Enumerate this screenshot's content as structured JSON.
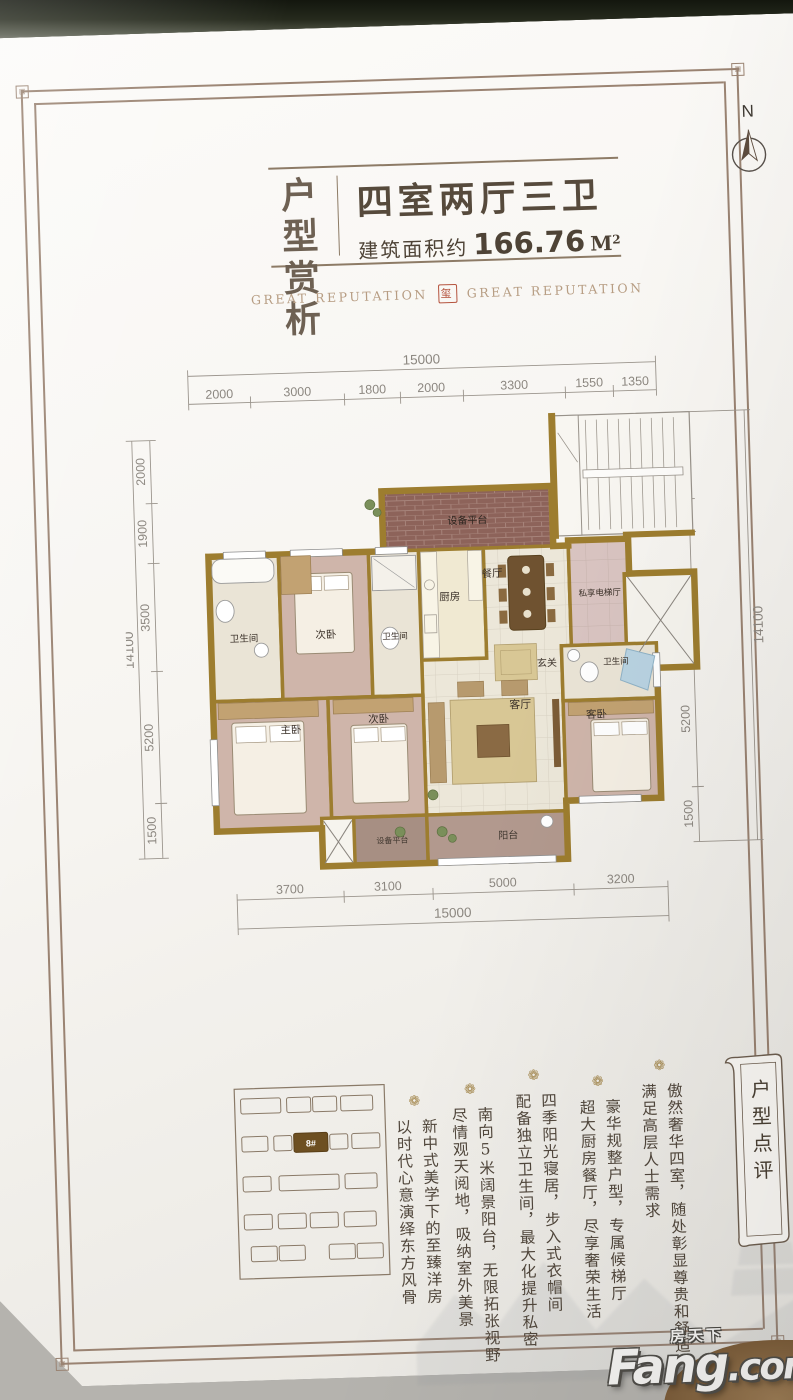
{
  "header": {
    "title_line1": "户型",
    "title_line2": "赏析",
    "type_title": "四室两厅三卫",
    "area_prefix": "建筑面积约",
    "area_value": "166.76",
    "area_unit": "M",
    "area_sup": "2",
    "reputation_left": "GREAT REPUTATION",
    "reputation_right": "GREAT REPUTATION",
    "seal_glyph": "玺"
  },
  "compass": {
    "label": "N"
  },
  "plan": {
    "dims": {
      "top_total": "15000",
      "top_segments": [
        "2000",
        "3000",
        "1800",
        "2000",
        "3300",
        "1550",
        "1350"
      ],
      "bottom_segments": [
        "3700",
        "3100",
        "5000",
        "3200"
      ],
      "bottom_total": "15000",
      "left_segments": [
        "2000",
        "1900",
        "3500",
        "5200",
        "1500"
      ],
      "left_total": "14100",
      "right_segments": [
        "2650",
        "1000",
        "3750",
        "5200",
        "1500"
      ],
      "right_total": "14100"
    },
    "rooms": {
      "equipment_platform": "设备平台",
      "kitchen": "厨房",
      "dining": "餐厅",
      "private_elevator_hall": "私享电梯厅",
      "foyer": "玄关",
      "bathroom": "卫生间",
      "secondary_bedroom": "次卧",
      "master_bedroom": "主卧",
      "living_room": "客厅",
      "guest_bedroom": "客卧",
      "balcony": "阳台"
    }
  },
  "siteplan": {
    "highlight_label": "8#"
  },
  "review": {
    "banner": "户型点评",
    "ornament_glyph": "❁",
    "comments": [
      {
        "main": "傲然奢华四室，随处彰显尊贵和舒适",
        "sub": "满足高层人士需求"
      },
      {
        "main": "豪华规整户型，专属候梯厅",
        "sub": "超大厨房餐厅，尽享奢荣生活"
      },
      {
        "main": "四季阳光寝居，步入式衣帽间",
        "sub": "配备独立卫生间，最大化提升私密"
      },
      {
        "main": "南向5米阔景阳台，无限拓张视野",
        "sub": "尽情观天阅地，吸纳室外美景"
      },
      {
        "main": "新中式美学下的至臻洋房",
        "sub": "以时代心意演绎东方风骨"
      }
    ]
  },
  "watermark": {
    "cn": "房天下",
    "en_main": "Fang",
    "en_suffix": ".com"
  },
  "colors": {
    "wall_gold": "#9d7d2f",
    "seal_red": "#b5543e",
    "brick": "#8d635a",
    "wood_floor": "#cfb5aa",
    "tile": "#ece7d9",
    "elevator_hall": "#d9c4c1",
    "balcony": "#b2998e",
    "text_dark": "#51473c",
    "highlight_building": "#6d4f21"
  }
}
